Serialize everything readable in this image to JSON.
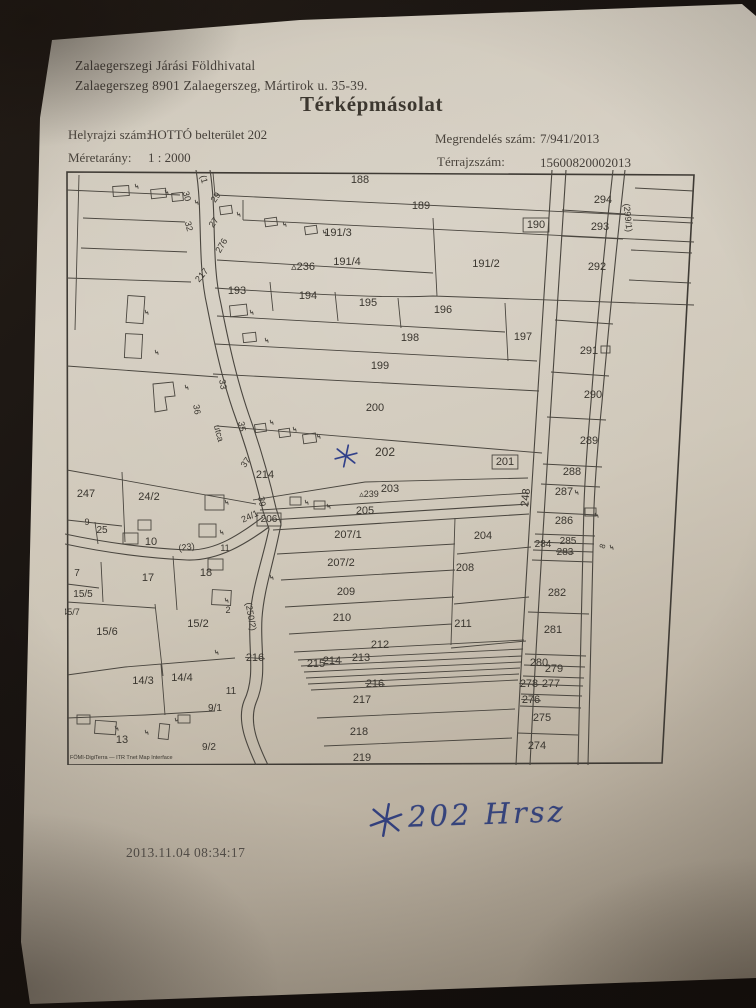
{
  "document": {
    "office_line1": "Zalaegerszegi Járási Földhivatal",
    "office_line2": "Zalaegerszeg 8901 Zalaegerszeg, Mártirok u. 35-39.",
    "title": "Térképmásolat",
    "helyrajzi_label": "Helyrajzi szám:",
    "helyrajzi_value": "HOTTÓ belterület 202",
    "meretarany_label": "Méretarány:",
    "meretarany_value": "1 : 2000",
    "megrendeles_label": "Megrendelés szám:",
    "megrendeles_value": "7/941/2013",
    "terrajz_label": "Térrajzszám:",
    "terrajz_value": "15600820002013"
  },
  "annotations": {
    "handwritten_note": "202 Hrsz",
    "timestamp": "2013.11.04 08:34:17"
  },
  "colors": {
    "paper": "#cdc5b6",
    "ink": "#3a362f",
    "map_line": "#4a463f",
    "handwriting_blue": "#36447d",
    "background": "#14100d"
  },
  "map": {
    "credit": "FÖMI-DigiTerra — ITR Tnet Map Interface",
    "labels": [
      {
        "t": "188",
        "x": 295,
        "y": 13
      },
      {
        "t": "189",
        "x": 356,
        "y": 39
      },
      {
        "t": "190",
        "x": 471,
        "y": 58,
        "box": true
      },
      {
        "t": "191/3",
        "x": 273,
        "y": 66
      },
      {
        "t": "191/4",
        "x": 282,
        "y": 95
      },
      {
        "t": "191/2",
        "x": 421,
        "y": 97
      },
      {
        "t": "236",
        "x": 238,
        "y": 100,
        "tri": true
      },
      {
        "t": "294",
        "x": 538,
        "y": 33
      },
      {
        "t": "293",
        "x": 535,
        "y": 60
      },
      {
        "t": "292",
        "x": 532,
        "y": 100
      },
      {
        "t": "193",
        "x": 172,
        "y": 124
      },
      {
        "t": "194",
        "x": 243,
        "y": 129
      },
      {
        "t": "195",
        "x": 303,
        "y": 136
      },
      {
        "t": "196",
        "x": 378,
        "y": 143
      },
      {
        "t": "198",
        "x": 345,
        "y": 171
      },
      {
        "t": "197",
        "x": 458,
        "y": 170
      },
      {
        "t": "291",
        "x": 524,
        "y": 184
      },
      {
        "t": "199",
        "x": 315,
        "y": 199
      },
      {
        "t": "290",
        "x": 528,
        "y": 228
      },
      {
        "t": "200",
        "x": 310,
        "y": 241
      },
      {
        "t": "289",
        "x": 524,
        "y": 274
      },
      {
        "t": "202",
        "x": 320,
        "y": 286,
        "s": 12
      },
      {
        "t": "201",
        "x": 440,
        "y": 295,
        "box": true
      },
      {
        "t": "288",
        "x": 507,
        "y": 305
      },
      {
        "t": "287",
        "x": 499,
        "y": 325
      },
      {
        "t": "203",
        "x": 325,
        "y": 322
      },
      {
        "t": "239",
        "x": 304,
        "y": 327,
        "s": 9,
        "tri": true
      },
      {
        "t": "205",
        "x": 300,
        "y": 344
      },
      {
        "t": "214",
        "x": 200,
        "y": 308
      },
      {
        "t": "247",
        "x": 21,
        "y": 327
      },
      {
        "t": "24/2",
        "x": 84,
        "y": 330
      },
      {
        "t": "286",
        "x": 499,
        "y": 354
      },
      {
        "t": "9",
        "x": 22,
        "y": 355,
        "s": 9
      },
      {
        "t": "25",
        "x": 37,
        "y": 363,
        "s": 10
      },
      {
        "t": "10",
        "x": 86,
        "y": 375
      },
      {
        "t": "206",
        "x": 204,
        "y": 352,
        "s": 10,
        "box": true
      },
      {
        "t": "285",
        "x": 503,
        "y": 374,
        "s": 10
      },
      {
        "t": "284",
        "x": 478,
        "y": 377,
        "s": 10
      },
      {
        "t": "283",
        "x": 500,
        "y": 385,
        "s": 10,
        "strike": true
      },
      {
        "t": "207/1",
        "x": 283,
        "y": 368
      },
      {
        "t": "204",
        "x": 418,
        "y": 369
      },
      {
        "t": "207/2",
        "x": 276,
        "y": 396
      },
      {
        "t": "208",
        "x": 400,
        "y": 401
      },
      {
        "t": "7",
        "x": 12,
        "y": 406,
        "s": 10
      },
      {
        "t": "17",
        "x": 83,
        "y": 411
      },
      {
        "t": "18",
        "x": 141,
        "y": 406
      },
      {
        "t": "11",
        "x": 160,
        "y": 381,
        "s": 9
      },
      {
        "t": "15/5",
        "x": 18,
        "y": 427,
        "s": 10
      },
      {
        "t": "209",
        "x": 281,
        "y": 425
      },
      {
        "t": "282",
        "x": 492,
        "y": 426
      },
      {
        "t": "2",
        "x": 163,
        "y": 443,
        "s": 9
      },
      {
        "t": "45/7",
        "x": 6,
        "y": 445,
        "s": 9
      },
      {
        "t": "210",
        "x": 277,
        "y": 451
      },
      {
        "t": "211",
        "x": 398,
        "y": 457
      },
      {
        "t": "281",
        "x": 488,
        "y": 463
      },
      {
        "t": "15/6",
        "x": 42,
        "y": 465
      },
      {
        "t": "15/2",
        "x": 133,
        "y": 457
      },
      {
        "t": "212",
        "x": 315,
        "y": 478
      },
      {
        "t": "213",
        "x": 296,
        "y": 491
      },
      {
        "t": "214",
        "x": 267,
        "y": 494,
        "strike": true
      },
      {
        "t": "215",
        "x": 251,
        "y": 497
      },
      {
        "t": "216",
        "x": 190,
        "y": 491,
        "strike": true
      },
      {
        "t": "280",
        "x": 474,
        "y": 496
      },
      {
        "t": "279",
        "x": 489,
        "y": 502
      },
      {
        "t": "278",
        "x": 464,
        "y": 517,
        "strike": true
      },
      {
        "t": "277",
        "x": 486,
        "y": 517
      },
      {
        "t": "276",
        "x": 466,
        "y": 533,
        "strike": true
      },
      {
        "t": "216",
        "x": 310,
        "y": 517,
        "strike": true
      },
      {
        "t": "14/3",
        "x": 78,
        "y": 514
      },
      {
        "t": "14/4",
        "x": 117,
        "y": 511
      },
      {
        "t": "11",
        "x": 166,
        "y": 524,
        "s": 10
      },
      {
        "t": "9/1",
        "x": 150,
        "y": 541,
        "s": 10
      },
      {
        "t": "217",
        "x": 297,
        "y": 533
      },
      {
        "t": "275",
        "x": 477,
        "y": 551
      },
      {
        "t": "13",
        "x": 57,
        "y": 573
      },
      {
        "t": "218",
        "x": 294,
        "y": 565
      },
      {
        "t": "9/2",
        "x": 144,
        "y": 580,
        "s": 10
      },
      {
        "t": "274",
        "x": 472,
        "y": 579
      },
      {
        "t": "219",
        "x": 297,
        "y": 591
      },
      {
        "t": "(1",
        "x": 136,
        "y": 10,
        "r": 75,
        "s": 9
      },
      {
        "t": "30",
        "x": 119,
        "y": 27,
        "r": 75,
        "s": 9
      },
      {
        "t": "29",
        "x": 153,
        "y": 29,
        "r": -55,
        "s": 9
      },
      {
        "t": "32",
        "x": 121,
        "y": 57,
        "r": 75,
        "s": 9
      },
      {
        "t": "27",
        "x": 151,
        "y": 54,
        "r": -55,
        "s": 9
      },
      {
        "t": "276",
        "x": 159,
        "y": 77,
        "r": -60,
        "s": 9
      },
      {
        "t": "217",
        "x": 139,
        "y": 107,
        "r": -50,
        "s": 9
      },
      {
        "t": "33",
        "x": 155,
        "y": 215,
        "r": 80,
        "s": 9
      },
      {
        "t": "36",
        "x": 129,
        "y": 240,
        "r": 80,
        "s": 9
      },
      {
        "t": "utca",
        "x": 151,
        "y": 264,
        "r": 75,
        "s": 9
      },
      {
        "t": "35",
        "x": 174,
        "y": 257,
        "r": 80,
        "s": 9
      },
      {
        "t": "37",
        "x": 183,
        "y": 294,
        "r": -55,
        "s": 9
      },
      {
        "t": "39",
        "x": 194,
        "y": 332,
        "r": 80,
        "s": 9
      },
      {
        "t": "24/1",
        "x": 186,
        "y": 349,
        "r": -25,
        "s": 9
      },
      {
        "t": "(23)",
        "x": 122,
        "y": 380,
        "r": -8,
        "s": 9
      },
      {
        "t": "(250/2)",
        "x": 183,
        "y": 447,
        "r": 80,
        "s": 9
      },
      {
        "t": "(299/1)",
        "x": 560,
        "y": 48,
        "r": 84,
        "s": 9
      },
      {
        "t": "248",
        "x": 464,
        "y": 328,
        "r": -84,
        "s": 11
      },
      {
        "t": "8",
        "x": 540,
        "y": 377,
        "r": -70,
        "s": 8
      }
    ]
  }
}
